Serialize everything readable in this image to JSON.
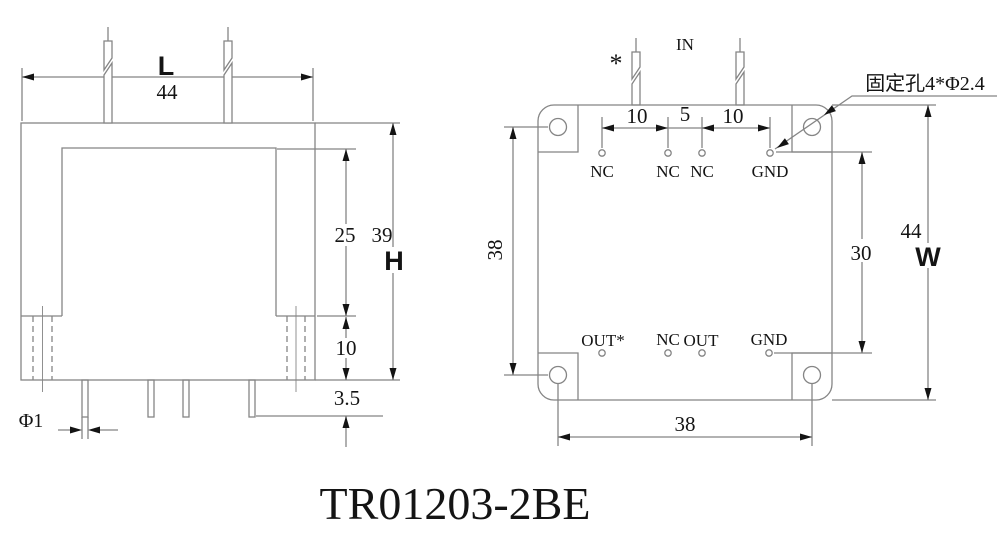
{
  "title": "TR01203-2BE",
  "colors": {
    "line": "#858585",
    "ink": "#141414",
    "background": "#ffffff"
  },
  "left_view": {
    "dim_width_label": "L",
    "dim_width_value": "44",
    "dim_window_height": "25",
    "dim_body_height_value": "39",
    "dim_body_height_label": "H",
    "dim_lower_height": "10",
    "dim_standoff": "3.5",
    "dim_pin_diameter": "Φ1"
  },
  "right_view": {
    "input_label": "IN",
    "polarity_mark": "*",
    "mounting_hole_note": "固定孔4*Φ2.4",
    "dim_pitch_left": "10",
    "dim_pitch_mid": "5",
    "dim_pitch_right": "10",
    "dim_hole_span_vertical": "38",
    "dim_pad_span_vertical": "30",
    "dim_depth_value": "44",
    "dim_depth_label": "W",
    "dim_hole_span_horizontal": "38",
    "top_pads": [
      "NC",
      "NC",
      "NC",
      "GND"
    ],
    "bottom_pads": [
      "OUT*",
      "NC",
      "OUT",
      "GND"
    ]
  }
}
